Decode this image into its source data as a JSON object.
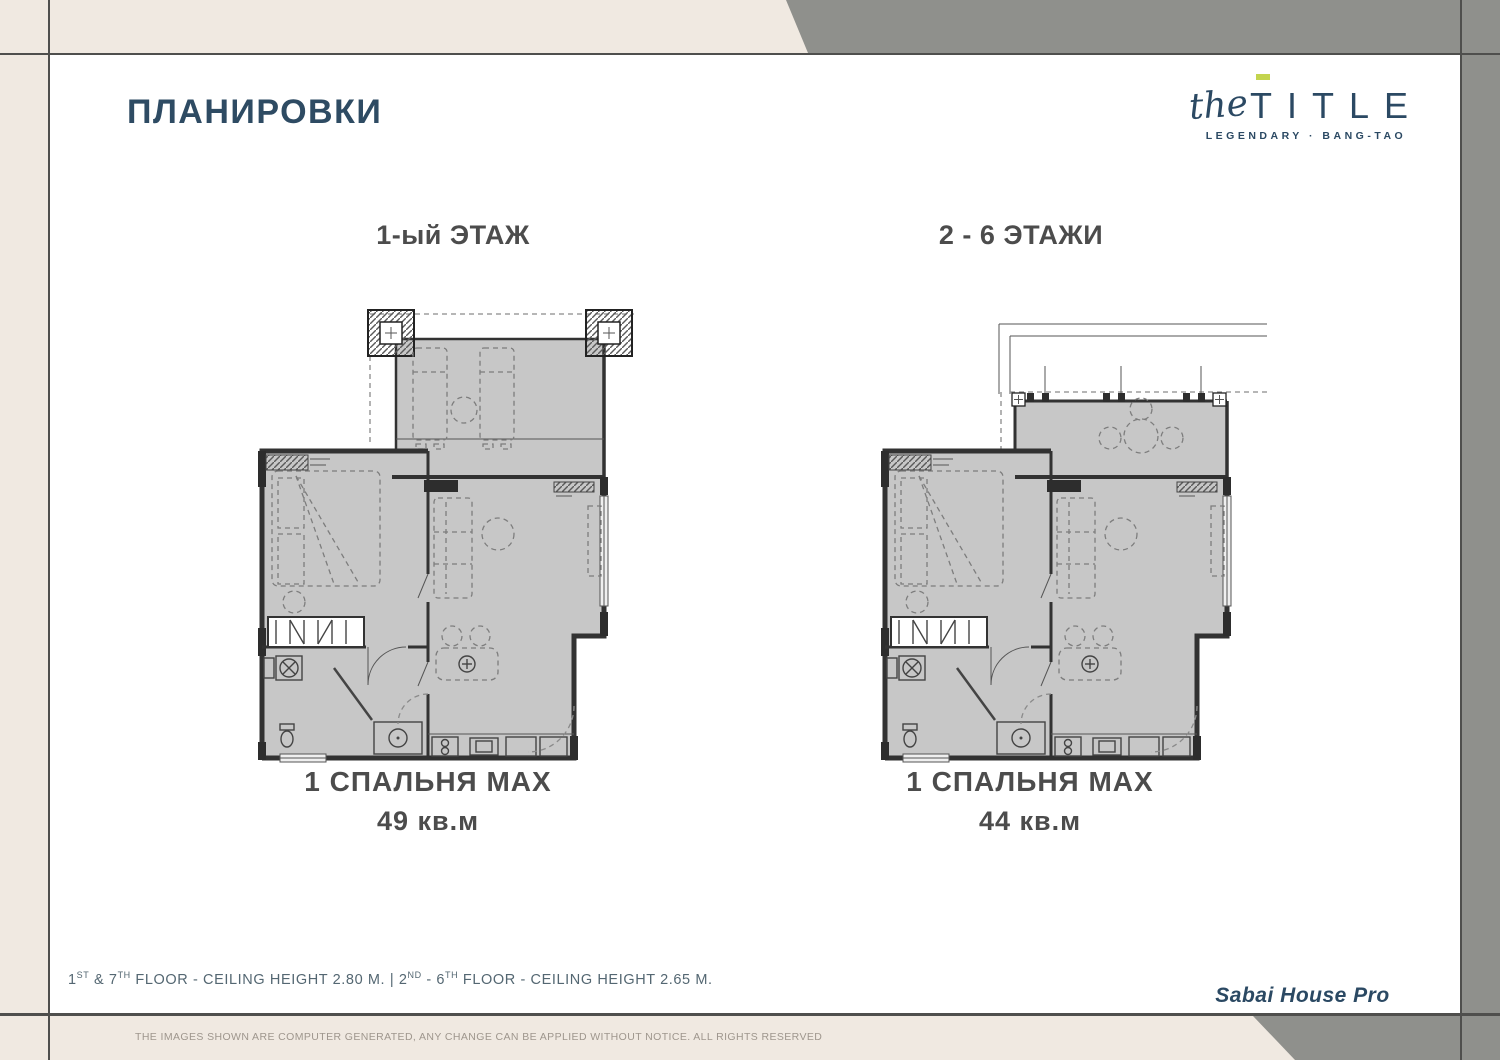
{
  "page": {
    "title": "ПЛАНИРОВКИ"
  },
  "logo": {
    "script": "the",
    "word_first": "T",
    "word_rest": "ITLE",
    "tagline": "LEGENDARY · BANG-TAO",
    "accent_color": "#c3d44e",
    "navy_color": "#2b4963"
  },
  "plans": [
    {
      "floor_label": "1-ый ЭТАЖ",
      "unit_label": "1 СПАЛЬНЯ MAX",
      "area_label": "49 кв.м"
    },
    {
      "floor_label": "2 - 6 ЭТАЖИ",
      "unit_label": "1 СПАЛЬНЯ MAX",
      "area_label": "44 кв.м"
    }
  ],
  "footer": {
    "note": {
      "p1": "1",
      "s1": "ST",
      "p2": " & 7",
      "s2": "TH",
      "p3": " FLOOR - CEILING HEIGHT 2.80 M. | 2",
      "s3": "ND",
      "p4": " - 6",
      "s4": "TH",
      "p5": " FLOOR - CEILING HEIGHT 2.65 M."
    },
    "project_name": "Sabai House Pro",
    "disclaimer": "THE IMAGES SHOWN ARE COMPUTER GENERATED, ANY CHANGE CAN BE APPLIED WITHOUT NOTICE. ALL RIGHTS RESERVED"
  },
  "colors": {
    "beige": "#f0e9e1",
    "margin_gray": "#8f908c",
    "frame_line": "#4f4f4d",
    "plan_fill": "#c7c7c7",
    "text_dark": "#4c4c4c",
    "note_slate": "#546772"
  }
}
